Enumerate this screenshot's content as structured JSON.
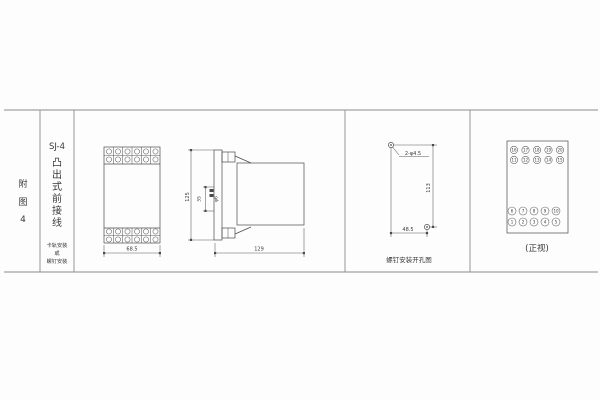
{
  "sheet": {
    "figure_label": [
      "附",
      "图",
      "4"
    ],
    "model": "SJ-4",
    "type_label": [
      "凸",
      "出",
      "式",
      "前",
      "接",
      "线"
    ],
    "mount_note": [
      "卡轨安装",
      "或",
      "螺钉安装"
    ]
  },
  "front_view": {
    "width_dim": "68.5"
  },
  "side_view": {
    "height_dim": "125",
    "depth_dim": "129",
    "pitch_dim": "35",
    "stud_dim": "φ6"
  },
  "drill_view": {
    "holes_label": "2-φ4.5",
    "vertical_dim": "113",
    "horizontal_dim": "48.5",
    "caption": "螺钉安装开孔图"
  },
  "terminal_view": {
    "rows": [
      [
        "16",
        "17",
        "18",
        "19",
        "20"
      ],
      [
        "11",
        "12",
        "13",
        "14",
        "15"
      ],
      [
        "6",
        "7",
        "8",
        "9",
        "10"
      ],
      [
        "1",
        "2",
        "3",
        "4",
        "5"
      ]
    ],
    "caption": "(正视)"
  },
  "colors": {
    "drawing_line": "#4a4a4a",
    "table_line": "#8c8c8c",
    "text": "#3a3a3a"
  }
}
